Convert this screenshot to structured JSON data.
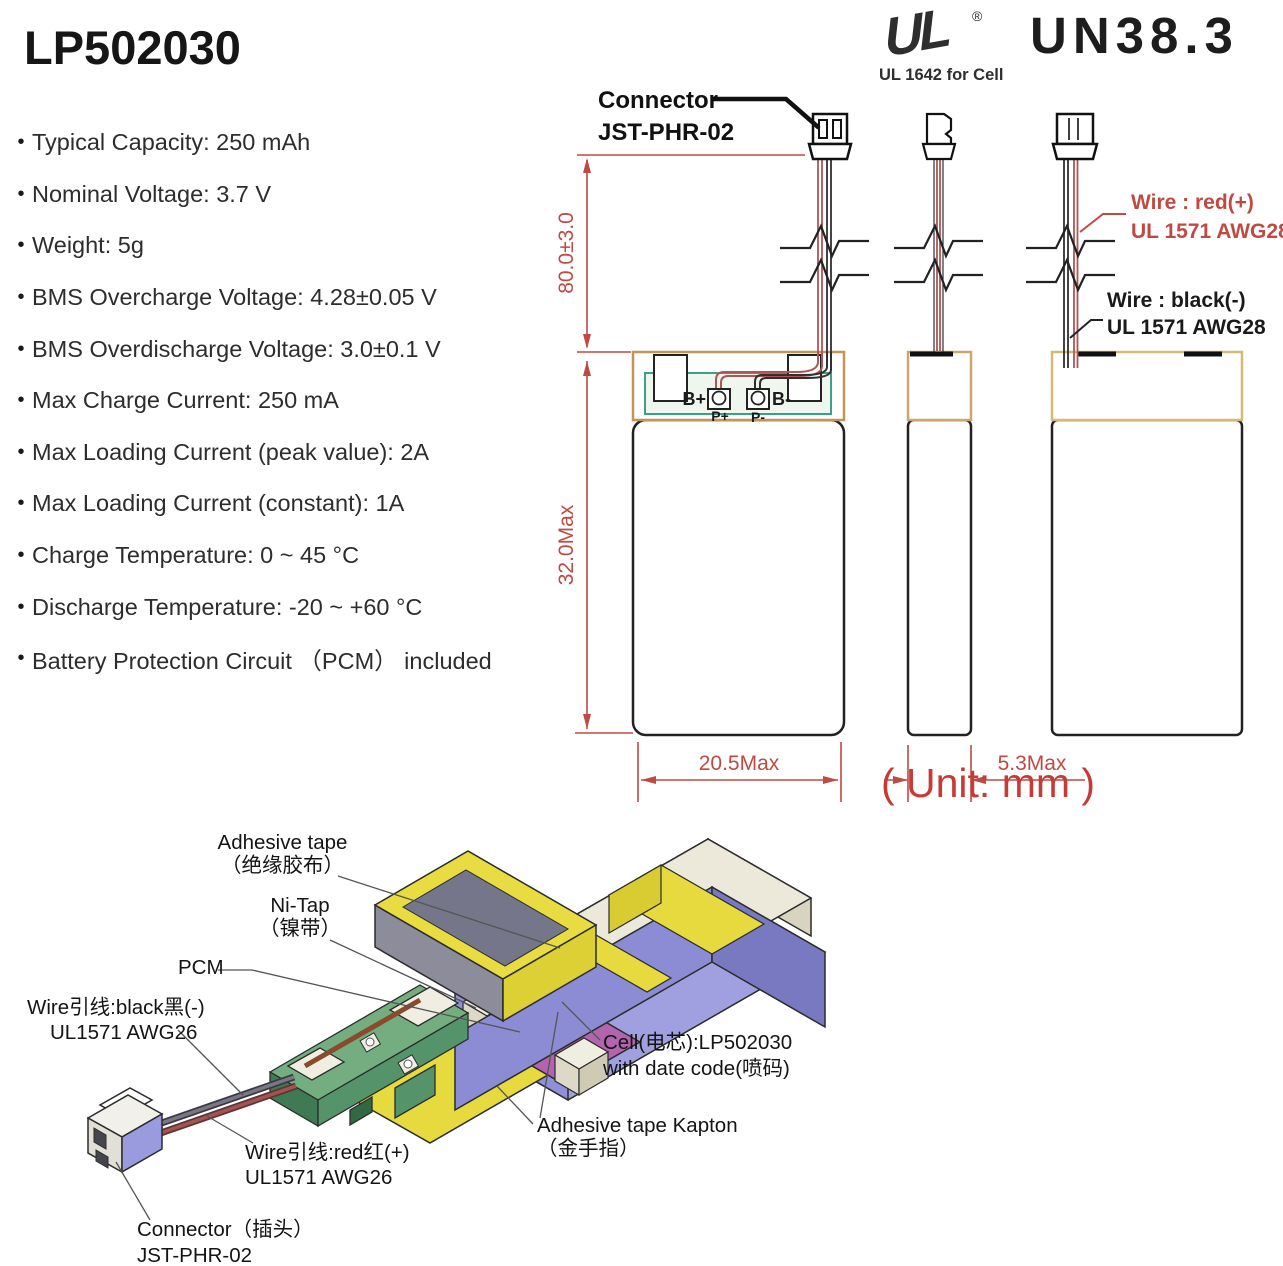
{
  "title": "LP502030",
  "bullet": "•",
  "certs": {
    "ul_mark": "UL",
    "ul_reg": "®",
    "ul_sub": "UL 1642 for Cell",
    "un": "UN38.3"
  },
  "specs": [
    "Typical Capacity: 250 mAh",
    "Nominal Voltage: 3.7 V",
    "Weight: 5g",
    "BMS Overcharge Voltage: 4.28±0.05 V",
    "BMS Overdischarge Voltage: 3.0±0.1 V",
    "Max Charge Current: 250 mA",
    "Max Loading Current (peak value): 2A",
    "Max Loading Current (constant): 1A",
    "Charge Temperature: 0 ~ 45 °C",
    "Discharge Temperature: -20 ~ +60 °C",
    "Battery Protection Circuit （PCM） included"
  ],
  "drawing": {
    "connector_l1": "Connector",
    "connector_l2": "JST-PHR-02",
    "dim_wire": "80.0±3.0",
    "dim_body": "32.0Max",
    "dim_width": "20.5Max",
    "dim_thick": "5.3Max",
    "unit": "( Unit: mm )",
    "wire_red_l1": "Wire : red(+)",
    "wire_red_l2": "UL 1571 AWG28",
    "wire_black_l1": "Wire : black(-)",
    "wire_black_l2": "UL 1571 AWG28",
    "b_plus": "B+",
    "p_plus": "P+",
    "p_minus": "P-",
    "b_minus": "B-"
  },
  "assembly": {
    "tape_l1": "Adhesive tape",
    "tape_l2": "（绝缘胶布）",
    "nitap_l1": "Ni-Tap",
    "nitap_l2": "（镍带）",
    "pcm": "PCM",
    "wblack_l1": "Wire引线:black黑(-)",
    "wblack_l2": "UL1571 AWG26",
    "wred_l1": "Wire引线:red红(+)",
    "wred_l2": "UL1571 AWG26",
    "cell_l1": "Cell(电芯):LP502030",
    "cell_l2": "with date code(喷码)",
    "kapton_l1": "Adhesive tape Kapton",
    "kapton_l2": "（金手指）",
    "conn_l1": "Connector（插头）",
    "conn_l2": "JST-PHR-02"
  },
  "colors": {
    "dim_red": "#bf4a42",
    "unit_red": "#c63b35",
    "tape_tan": "#c49455",
    "pcb_green_stroke": "#3aa088",
    "cell_purple": "#8c8cd4",
    "cream": "#ece9db",
    "tape_yellow": "#e6da3e",
    "pcm_magenta": "#b264ae",
    "pcb3d_green": "#74ae80",
    "wire_red": "#9c4a4a"
  }
}
